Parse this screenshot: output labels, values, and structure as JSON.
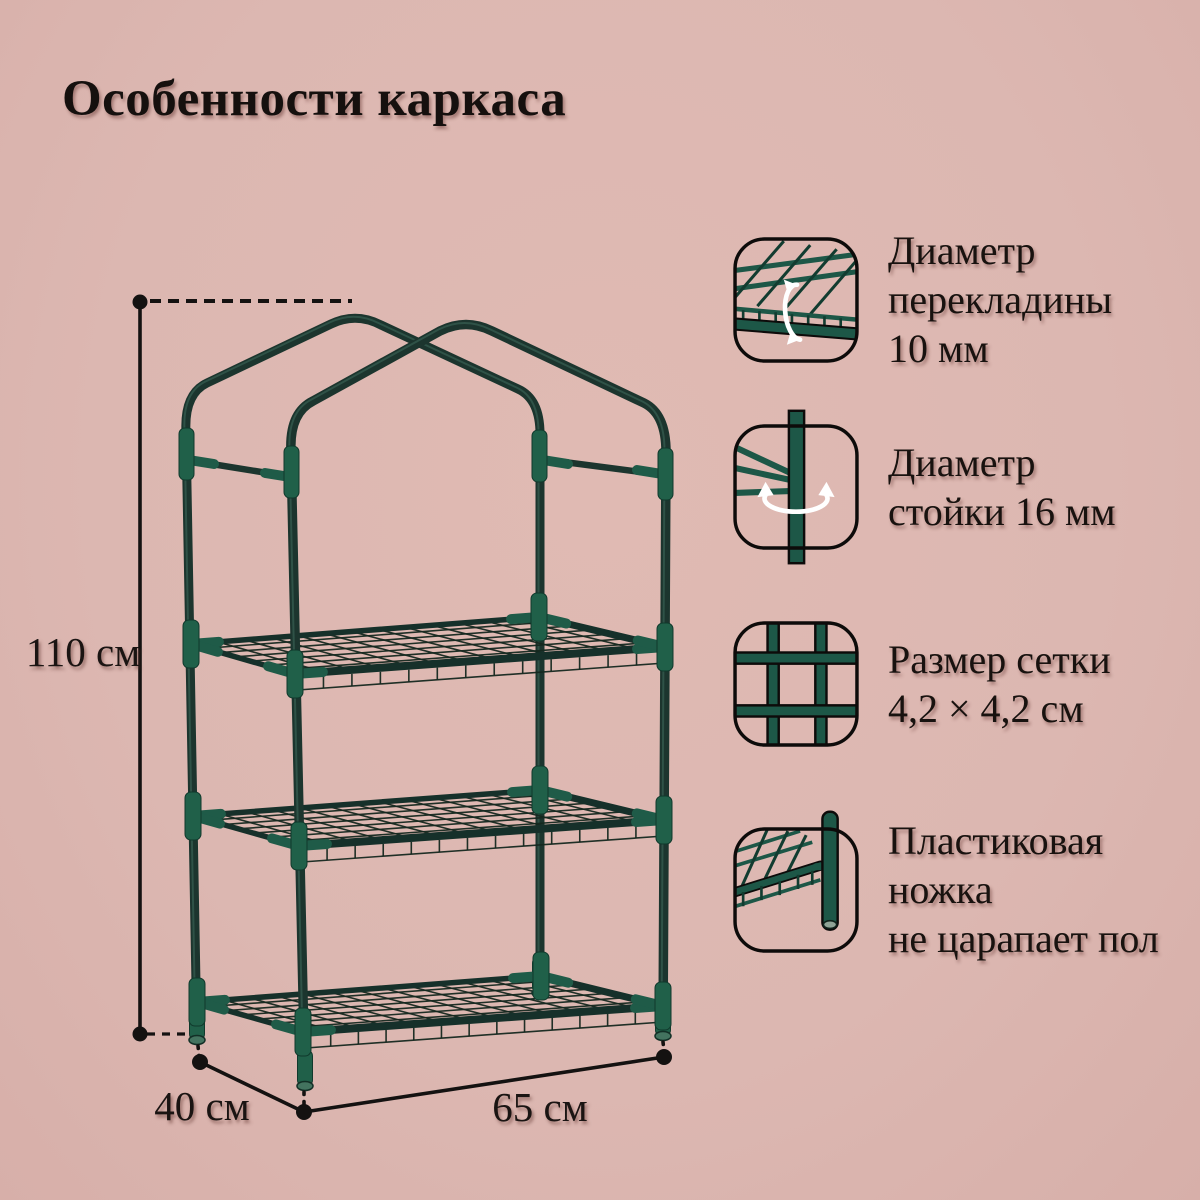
{
  "title": "Особенности каркаса",
  "colors": {
    "background": "#dcb7b1",
    "frame_tube": "#1c352e",
    "connector_green": "#1f5b48",
    "icon_green": "#1d5747",
    "text": "#18120f",
    "arrow_white": "#ffffff"
  },
  "diagram": {
    "height_label": "110 см",
    "depth_label": "40 см",
    "width_label": "65 см"
  },
  "features": [
    {
      "icon": "crossbar-diameter-icon",
      "lines": [
        "Диаметр",
        "перекладины",
        "10 мм"
      ]
    },
    {
      "icon": "post-diameter-icon",
      "lines": [
        "Диаметр",
        "стойки 16 мм"
      ]
    },
    {
      "icon": "mesh-size-icon",
      "lines": [
        "Размер сетки",
        "4,2 × 4,2 см"
      ]
    },
    {
      "icon": "plastic-foot-icon",
      "lines": [
        "Пластиковая",
        "ножка",
        "не царапает пол"
      ]
    }
  ]
}
